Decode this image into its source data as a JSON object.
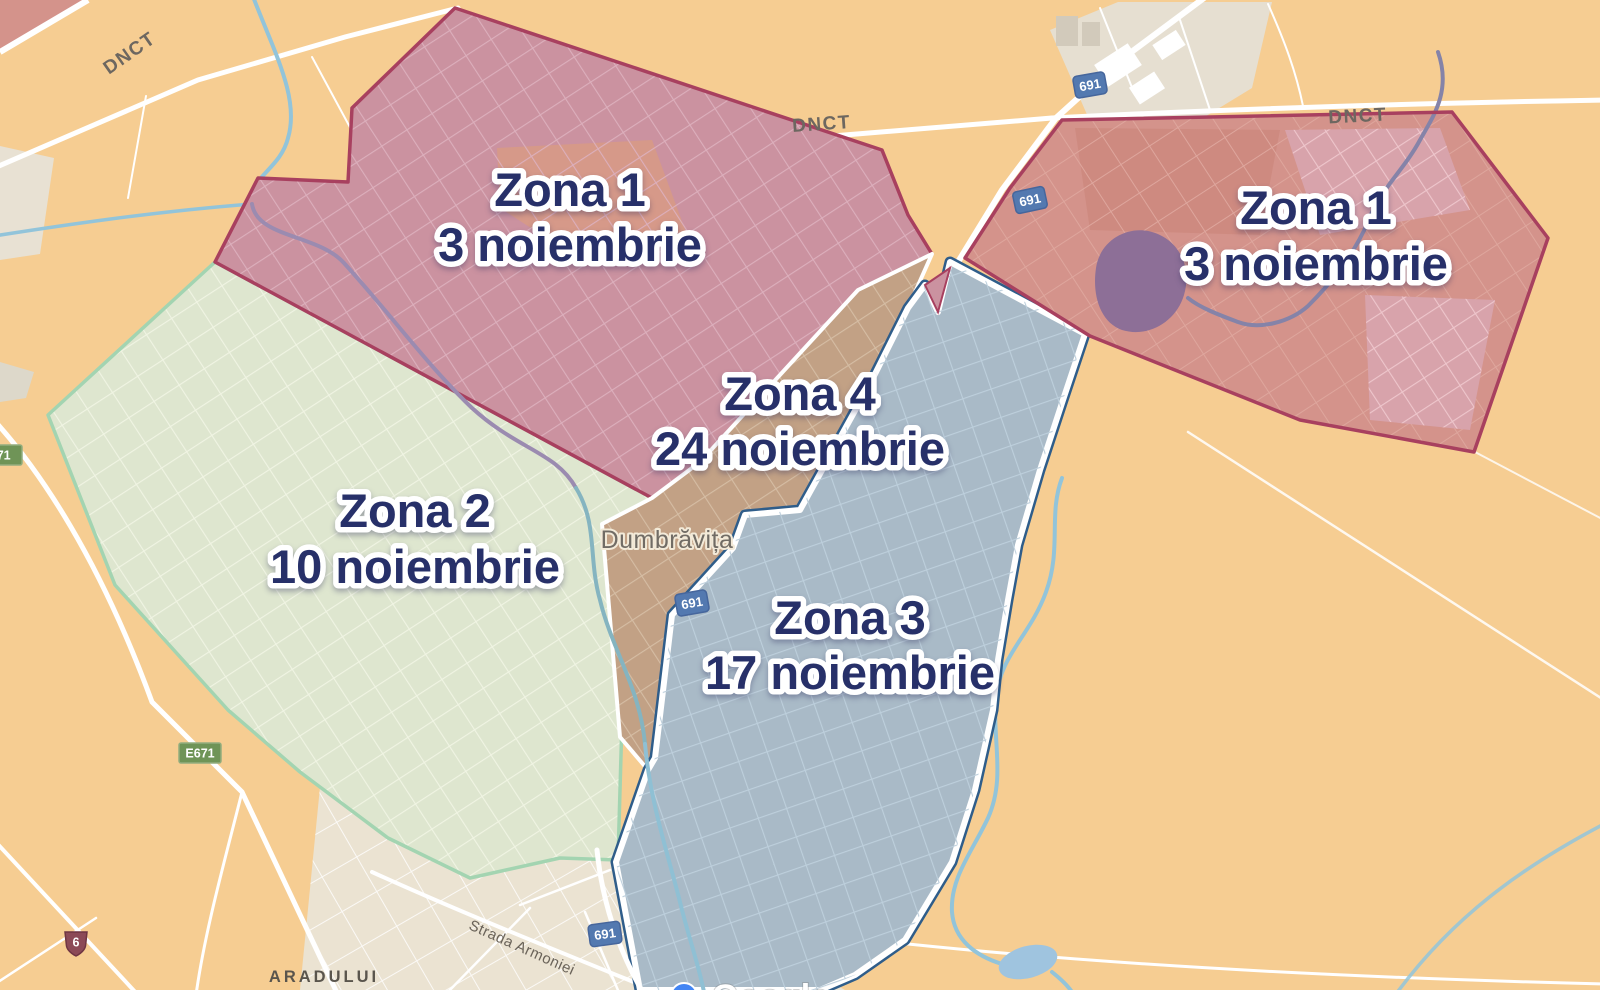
{
  "zones": [
    {
      "name": "Zona 1",
      "date": "3 noiembrie",
      "fill": "#cb92a0",
      "border": "#a8405f"
    },
    {
      "name": "Zona 1",
      "date": "3 noiembrie",
      "fill": "#d4938b",
      "border": "#a8405f"
    },
    {
      "name": "Zona 2",
      "date": "10 noiembrie",
      "fill": "#dee6cf",
      "border": "#a3d4b1"
    },
    {
      "name": "Zona 3",
      "date": "17 noiembrie",
      "fill": "#a9bac7",
      "border": "#ffffff"
    },
    {
      "name": "Zona 4",
      "date": "24 noiembrie",
      "fill": "#c2a185",
      "border": "#ffffff"
    }
  ],
  "labels": {
    "place": "Dumbrăvița",
    "district": "ARADULUI",
    "street": "Strada Armoniei",
    "road_dnct": "DNCT",
    "watermark": "Google"
  },
  "shields": {
    "s691": "691",
    "e671": "E671",
    "n6": "6"
  },
  "colors": {
    "background": "#f6cd92",
    "urban_area": "#ebe3d2",
    "industrial_area": "#e6dfd1",
    "road": "#ffffff",
    "water": "#92c4da",
    "lake_under_zone": "#8d6f97",
    "label_navy": "#273069",
    "label_halo": "#ffffff",
    "shield_blue": "#5379b0",
    "shield_green": "#6f9457",
    "shield_badge": "#8c4a57"
  }
}
